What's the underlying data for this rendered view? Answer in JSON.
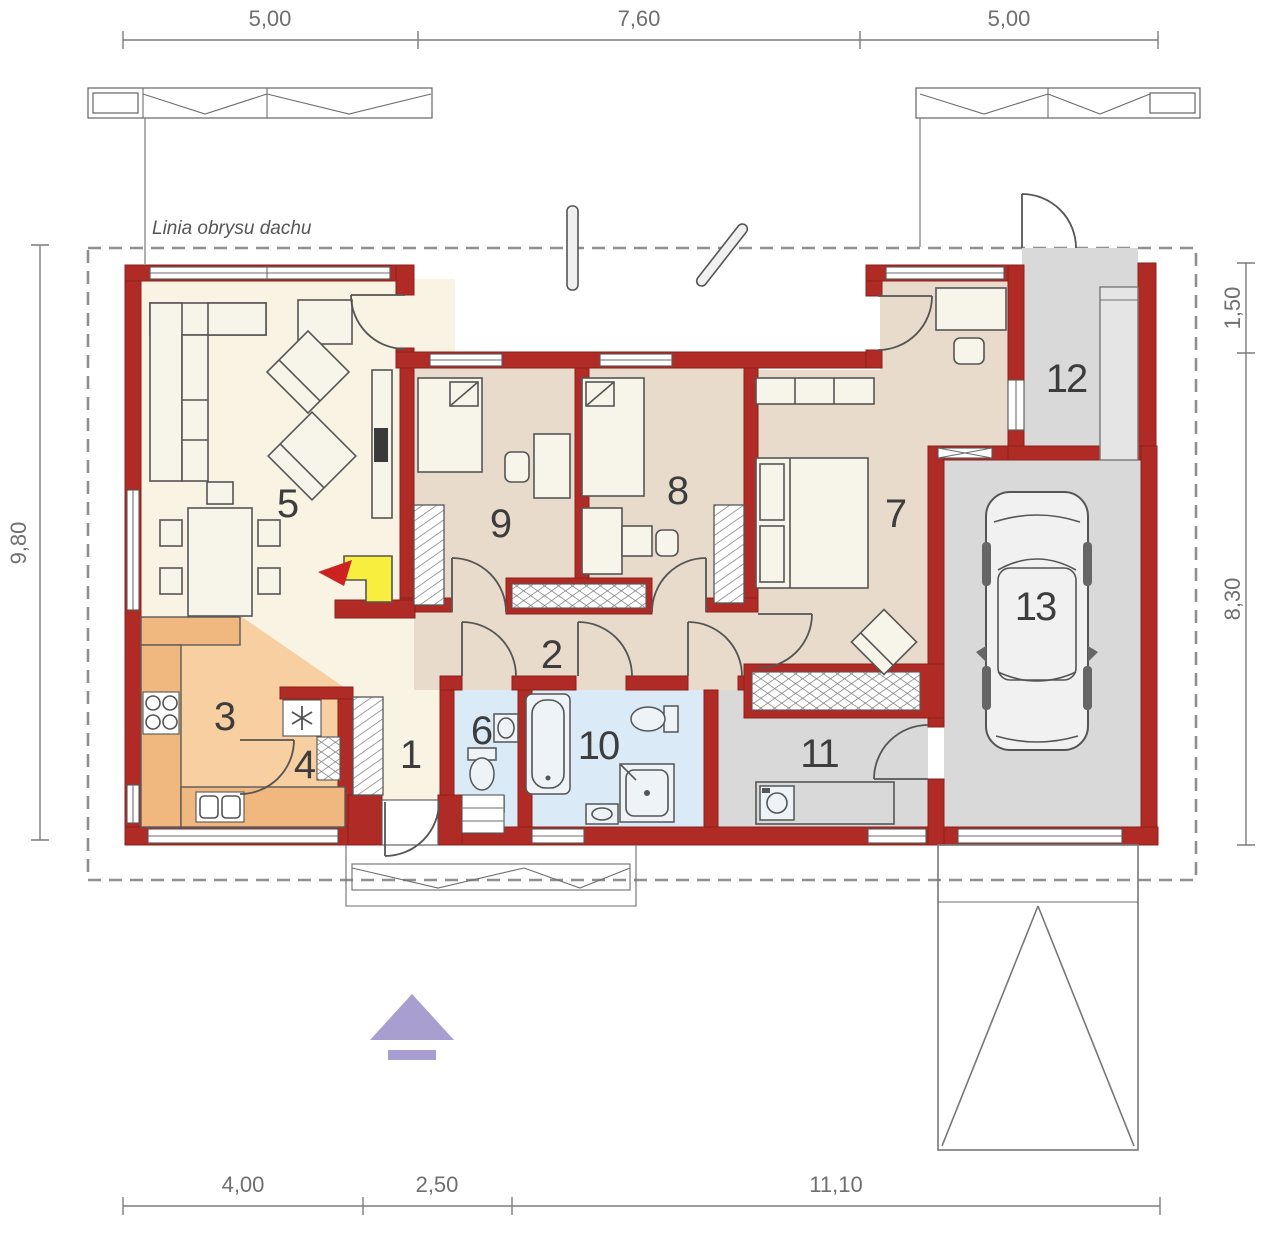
{
  "roof_outline_label": "Linia obrysu dachu",
  "dimensions": {
    "top": [
      "5,00",
      "7,60",
      "5,00"
    ],
    "bottom": [
      "4,00",
      "2,50",
      "11,10"
    ],
    "left": [
      "9,80"
    ],
    "right": [
      "1,50",
      "8,30"
    ]
  },
  "rooms": [
    {
      "number": "1"
    },
    {
      "number": "2"
    },
    {
      "number": "3"
    },
    {
      "number": "4"
    },
    {
      "number": "5"
    },
    {
      "number": "6"
    },
    {
      "number": "7"
    },
    {
      "number": "8"
    },
    {
      "number": "9"
    },
    {
      "number": "10"
    },
    {
      "number": "11"
    },
    {
      "number": "12"
    },
    {
      "number": "13"
    }
  ],
  "icons": {
    "fireplace": "flame-arrow",
    "fridge": "asterisk-snowflake",
    "entrance_marker": "up-triangle-with-bar",
    "car": "car-top-view"
  },
  "colors": {
    "wall": "#b02b25",
    "walledge": "#8d221d",
    "cream": "#f8f3e2",
    "tan": "#e8dbcb",
    "orange": "#f7cfa0",
    "orangedk": "#f0b87e",
    "blue": "#daeaf6",
    "gray": "#d9d9d9",
    "dash": "#8f8f8f",
    "fireplace_yellow": "#f8ee3d",
    "accent_red": "#cc2222",
    "marker_purple": "#a89ecf"
  }
}
